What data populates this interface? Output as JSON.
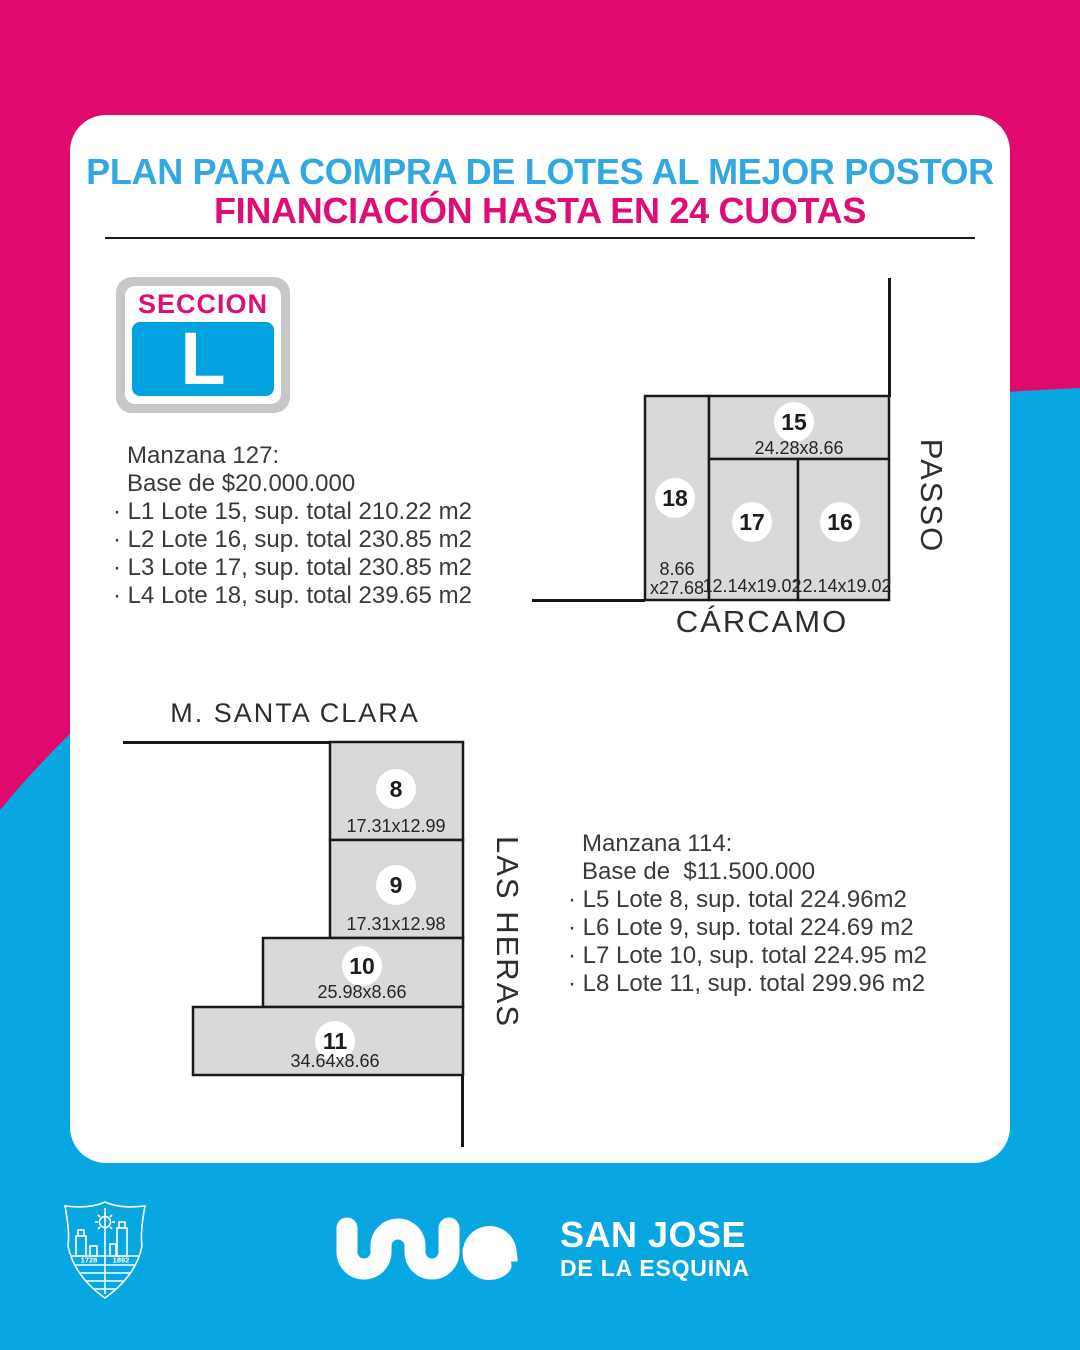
{
  "header": {
    "title_line1": "PLAN PARA COMPRA DE LOTES AL MEJOR POSTOR",
    "title_line2": "FINANCIACIÓN HASTA EN 24 CUOTAS"
  },
  "badge": {
    "label": "SECCION",
    "letter": "L"
  },
  "manzana_127": {
    "title": "Manzana 127:",
    "base": "Base de $20.000.000",
    "items": [
      "· L1 Lote 15, sup. total 210.22 m2",
      "· L2 Lote 16, sup. total 230.85 m2",
      "· L3 Lote 17, sup. total 230.85 m2",
      "· L4 Lote 18, sup. total 239.65 m2"
    ]
  },
  "diagram_carcamo": {
    "street_right": "PASSO",
    "street_bottom": "CÁRCAMO",
    "lots": [
      {
        "number": "15",
        "dims": "24.28x8.66"
      },
      {
        "number": "16",
        "dims": "12.14x19.02"
      },
      {
        "number": "17",
        "dims": "12.14x19.02"
      },
      {
        "number": "18",
        "dims_line1": "8.66",
        "dims_line2": "x27.68"
      }
    ]
  },
  "manzana_114": {
    "title": "Manzana 114:",
    "base": "Base de  $11.500.000",
    "items": [
      "· L5 Lote 8, sup. total 224.96m2",
      "· L6 Lote 9, sup. total 224.69 m2",
      "· L7 Lote 10, sup. total 224.95 m2",
      "· L8 Lote 11, sup. total 299.96 m2"
    ]
  },
  "diagram_santa_clara": {
    "street_top": "M. SANTA CLARA",
    "street_right": "LAS HERAS",
    "lots": [
      {
        "number": "8",
        "dims": "17.31x12.99"
      },
      {
        "number": "9",
        "dims": "17.31x12.98"
      },
      {
        "number": "10",
        "dims": "25.98x8.66"
      },
      {
        "number": "11",
        "dims": "34.64x8.66"
      }
    ]
  },
  "footer": {
    "brand_name": "SAN JOSE",
    "brand_tagline": "DE LA ESQUINA",
    "crest_year_left": "1728",
    "crest_year_right": "1892"
  },
  "colors": {
    "pink_bg": "#e0096e",
    "blue_bg": "#09a7e1",
    "title_blue": "#31a9e0",
    "title_pink": "#e00d77",
    "badge_blue": "#00a3df",
    "lot_fill": "#d9d9d9"
  }
}
